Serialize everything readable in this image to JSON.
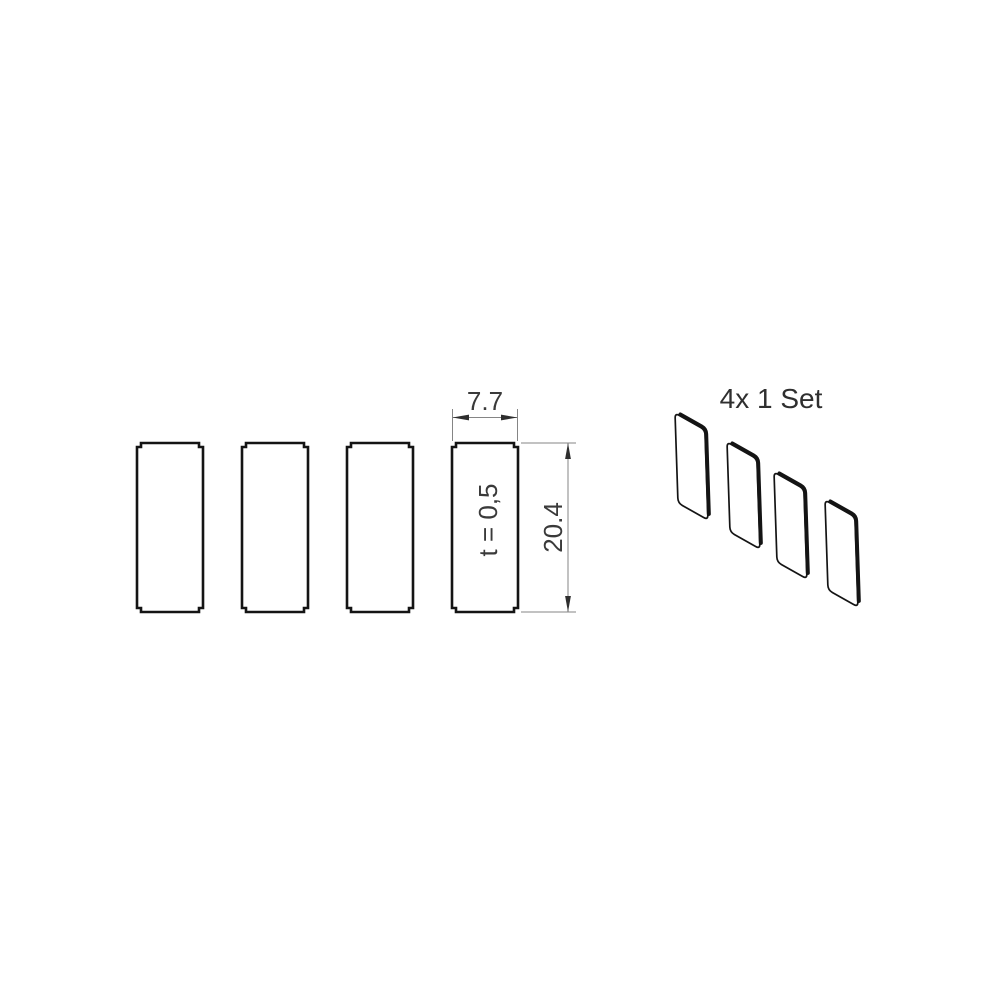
{
  "front_view": {
    "plate_count": 4,
    "width_dim_label": "7.7",
    "height_dim_label": "20.4",
    "thickness_label": "t = 0,5"
  },
  "iso_view": {
    "plate_count": 4,
    "set_label": "4x 1 Set"
  },
  "colors": {
    "background": "#ffffff",
    "outline": "#141414",
    "dimension_line": "#858585",
    "arrow": "#2e2e2e",
    "text": "#3a3a3a"
  }
}
